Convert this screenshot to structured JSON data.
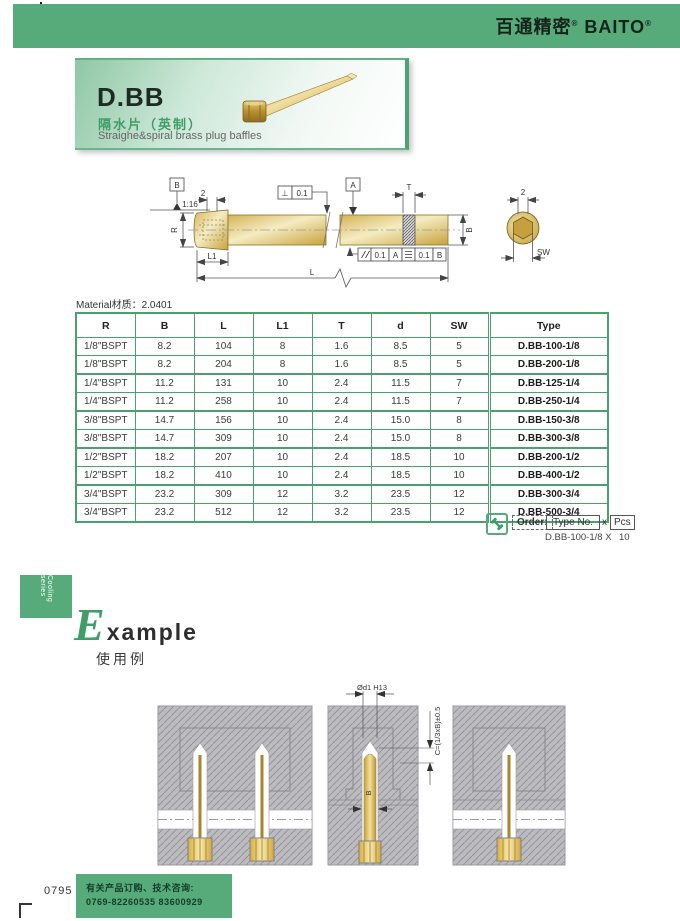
{
  "header": {
    "brand_cn": "百通精密",
    "brand_en": "BAITO",
    "reg": "®"
  },
  "banner": {
    "code": "D.BB",
    "name_cn": "隔水片（英制）",
    "name_en": "Straighe&spiral brass plug baffles"
  },
  "drawing": {
    "datum_b": "B",
    "datum_a": "A",
    "taper": "1:16",
    "dim_two": "2",
    "dim_two_end": "2",
    "label_r": "R",
    "label_l1": "L1",
    "label_l": "L",
    "label_t": "T",
    "label_b": "B",
    "label_sw": "SW",
    "frame_perp_sym": "⊥",
    "frame_perp_val": "0.1",
    "frame_par_val": "0.1",
    "frame_par_datum": "A",
    "frame_str_val": "0.1",
    "frame_str_datum": "B"
  },
  "material_label": "Material材质：2.0401",
  "table": {
    "headers": [
      "R",
      "B",
      "L",
      "L1",
      "T",
      "d",
      "SW",
      "Type"
    ],
    "rows": [
      [
        "1/8\"BSPT",
        "8.2",
        "104",
        "8",
        "1.6",
        "8.5",
        "5",
        "D.BB-100-1/8"
      ],
      [
        "1/8\"BSPT",
        "8.2",
        "204",
        "8",
        "1.6",
        "8.5",
        "5",
        "D.BB-200-1/8"
      ],
      [
        "1/4\"BSPT",
        "11.2",
        "131",
        "10",
        "2.4",
        "11.5",
        "7",
        "D.BB-125-1/4"
      ],
      [
        "1/4\"BSPT",
        "11.2",
        "258",
        "10",
        "2.4",
        "11.5",
        "7",
        "D.BB-250-1/4"
      ],
      [
        "3/8\"BSPT",
        "14.7",
        "156",
        "10",
        "2.4",
        "15.0",
        "8",
        "D.BB-150-3/8"
      ],
      [
        "3/8\"BSPT",
        "14.7",
        "309",
        "10",
        "2.4",
        "15.0",
        "8",
        "D.BB-300-3/8"
      ],
      [
        "1/2\"BSPT",
        "18.2",
        "207",
        "10",
        "2.4",
        "18.5",
        "10",
        "D.BB-200-1/2"
      ],
      [
        "1/2\"BSPT",
        "18.2",
        "410",
        "10",
        "2.4",
        "18.5",
        "10",
        "D.BB-400-1/2"
      ],
      [
        "3/4\"BSPT",
        "23.2",
        "309",
        "12",
        "3.2",
        "23.5",
        "12",
        "D.BB-300-3/4"
      ],
      [
        "3/4\"BSPT",
        "23.2",
        "512",
        "12",
        "3.2",
        "23.5",
        "12",
        "D.BB-500-3/4"
      ]
    ]
  },
  "order": {
    "label": "Order:",
    "type_no": "Type No.",
    "times": "x",
    "pcs": "Pcs",
    "example_type": "D.BB-100-1/8 X",
    "example_qty": "10"
  },
  "side_tab": "Cooling series",
  "example": {
    "initial": "E",
    "rest": "xample",
    "cn": "使用例"
  },
  "diagrams": {
    "dim_d1": "Ød1 H13",
    "dim_c": "C=(1/3xB)±0.5",
    "label_b": "B"
  },
  "footer": {
    "page": "0795",
    "line1": "有关产品订购、技术咨询:",
    "line2": "0769-82260535  83600929"
  },
  "colors": {
    "green": "#57ab7b",
    "green-dark": "#3f9e68",
    "border-green": "#4aa06e"
  }
}
